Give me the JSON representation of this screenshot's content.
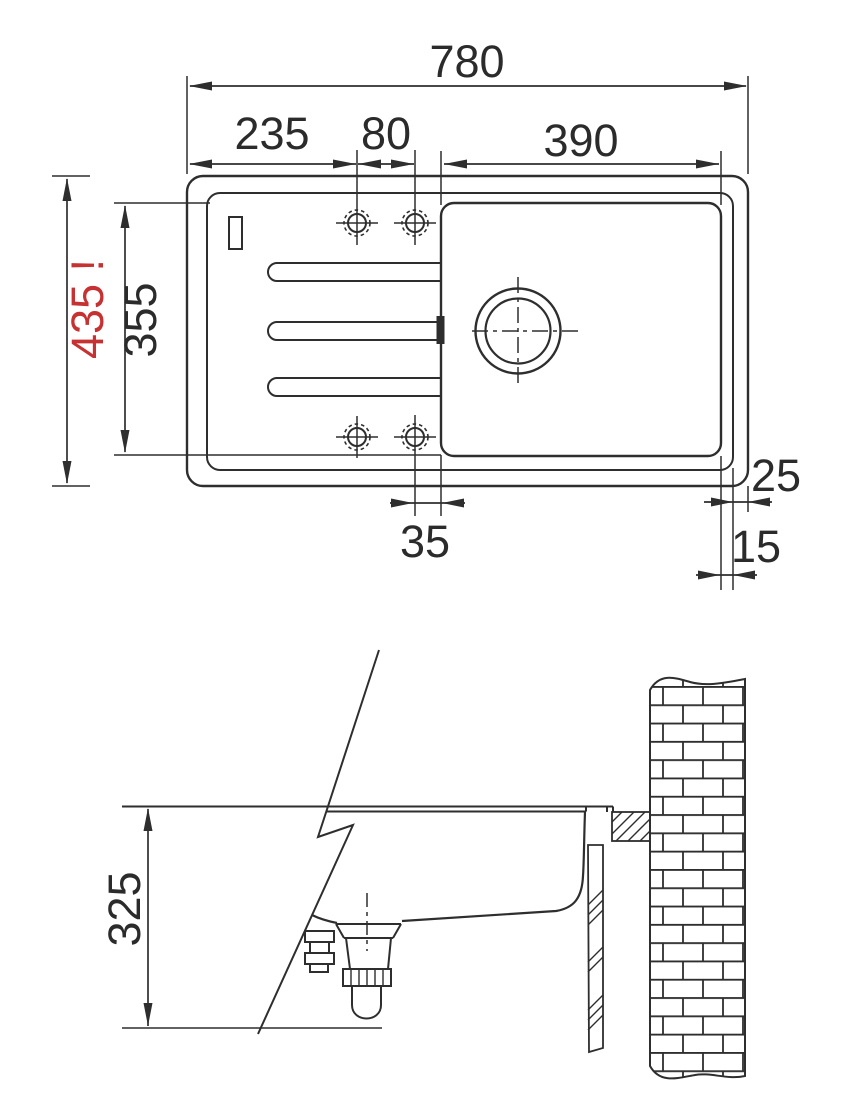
{
  "drawing": {
    "kind": "sink-installation-technical-drawing",
    "views": [
      "top-view",
      "section-view"
    ]
  },
  "dimensions": {
    "top_width_total": "780",
    "top_width_drainer": "235",
    "top_holes_spacing": "80",
    "top_bowl_width": "390",
    "side_height_total": "435 !",
    "side_height_inner": "355",
    "bottom_hole_offset": "35",
    "edge_offset_outer": "25",
    "edge_offset_inner": "15",
    "section_depth": "325"
  },
  "colors": {
    "line": "#2e2e2e",
    "text": "#2b2b2b",
    "alert_red": "#c63131",
    "background": "#ffffff"
  }
}
